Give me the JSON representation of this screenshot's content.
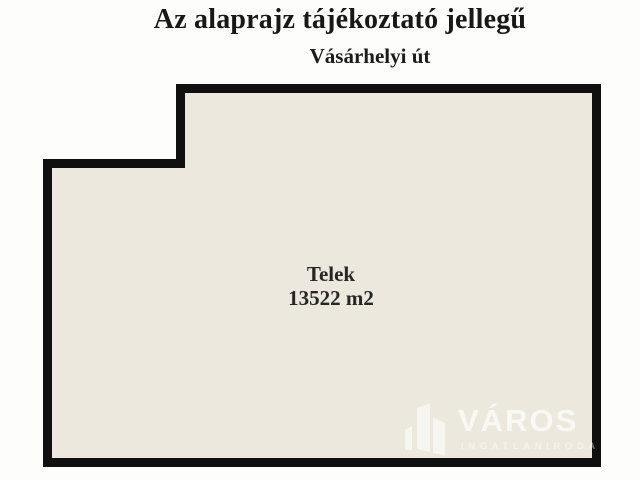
{
  "header": {
    "title": "Az alaprajz tájékoztató jellegű",
    "street": "Vásárhelyi út"
  },
  "plot": {
    "label": "Telek",
    "area": "13522 m2",
    "fill_color": "#ece8dd",
    "border_color": "#101010"
  },
  "watermark": {
    "brand": "VÁROS",
    "tagline": "INGATLANIRODA"
  }
}
